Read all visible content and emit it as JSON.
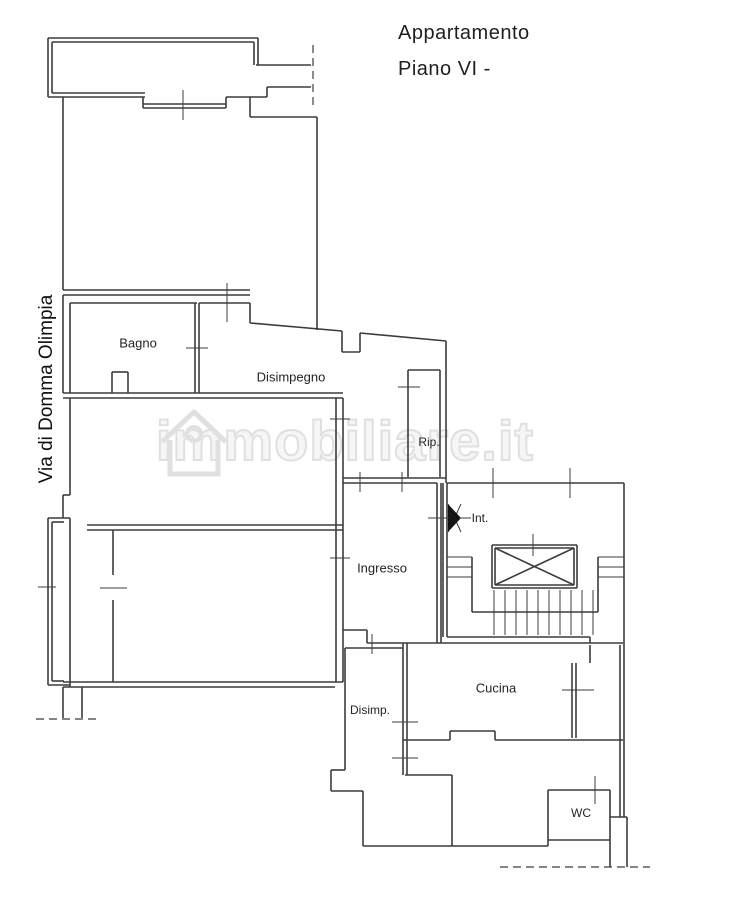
{
  "title": {
    "line1": "Appartamento",
    "line2": "Piano VI -"
  },
  "street_label": "Via di Domma Olimpia",
  "watermark": {
    "text": "immobiliare.it",
    "icon": "house-icon",
    "color": "#e0e0e0"
  },
  "colors": {
    "wall": "#3c3c3c",
    "background": "#ffffff",
    "label": "#242424"
  },
  "rooms": [
    {
      "id": "bagno",
      "label": "Bagno",
      "x": 138,
      "y": 343,
      "size": "normal"
    },
    {
      "id": "disimpegno",
      "label": "Disimpegno",
      "x": 291,
      "y": 377,
      "size": "normal"
    },
    {
      "id": "rip",
      "label": "Rip.",
      "x": 429,
      "y": 442,
      "size": "small"
    },
    {
      "id": "int",
      "label": "Int.",
      "x": 480,
      "y": 518,
      "size": "small"
    },
    {
      "id": "ingresso",
      "label": "Ingresso",
      "x": 382,
      "y": 568,
      "size": "normal"
    },
    {
      "id": "cucina",
      "label": "Cucina",
      "x": 496,
      "y": 688,
      "size": "normal"
    },
    {
      "id": "disimp",
      "label": "Disimp.",
      "x": 370,
      "y": 710,
      "size": "small"
    },
    {
      "id": "wc",
      "label": "WC",
      "x": 581,
      "y": 813,
      "size": "small"
    }
  ],
  "plan": {
    "walls": [
      [
        48,
        38,
        258,
        38
      ],
      [
        48,
        38,
        48,
        97
      ],
      [
        258,
        38,
        258,
        65
      ],
      [
        52,
        42,
        254,
        42
      ],
      [
        52,
        42,
        52,
        93
      ],
      [
        254,
        42,
        254,
        65
      ],
      [
        48,
        97,
        145,
        97
      ],
      [
        52,
        93,
        145,
        93
      ],
      [
        143,
        97,
        143,
        108
      ],
      [
        226,
        97,
        226,
        108
      ],
      [
        143,
        104,
        226,
        104
      ],
      [
        143,
        108,
        226,
        108
      ],
      [
        226,
        97,
        267,
        97
      ],
      [
        267,
        87,
        267,
        97
      ],
      [
        267,
        87,
        311,
        87
      ],
      [
        256,
        65,
        311,
        65
      ],
      [
        63,
        97,
        63,
        290
      ],
      [
        250,
        97,
        250,
        117
      ],
      [
        250,
        117,
        317,
        117
      ],
      [
        317,
        117,
        317,
        330
      ],
      [
        63,
        290,
        250,
        290
      ],
      [
        63,
        295,
        250,
        295
      ],
      [
        63,
        295,
        63,
        393
      ],
      [
        70,
        303,
        197,
        303
      ],
      [
        70,
        303,
        70,
        393
      ],
      [
        63,
        393,
        197,
        393
      ],
      [
        112,
        372,
        112,
        393
      ],
      [
        112,
        372,
        128,
        372
      ],
      [
        128,
        372,
        128,
        393
      ],
      [
        195,
        303,
        195,
        393
      ],
      [
        199,
        303,
        199,
        393
      ],
      [
        199,
        303,
        250,
        303
      ],
      [
        250,
        303,
        250,
        323
      ],
      [
        250,
        323,
        342,
        331
      ],
      [
        342,
        331,
        342,
        352
      ],
      [
        342,
        352,
        360,
        352
      ],
      [
        360,
        352,
        360,
        333
      ],
      [
        360,
        333,
        446,
        341
      ],
      [
        446,
        341,
        446,
        483
      ],
      [
        408,
        370,
        440,
        370
      ],
      [
        408,
        370,
        408,
        477
      ],
      [
        440,
        370,
        440,
        477
      ],
      [
        343,
        478,
        446,
        478
      ],
      [
        343,
        483,
        437,
        483
      ],
      [
        336,
        398,
        336,
        682
      ],
      [
        343,
        398,
        343,
        682
      ],
      [
        63,
        398,
        343,
        398
      ],
      [
        197,
        393,
        343,
        393
      ],
      [
        70,
        398,
        70,
        495
      ],
      [
        70,
        495,
        63,
        495
      ],
      [
        63,
        495,
        63,
        518
      ],
      [
        48,
        518,
        48,
        685
      ],
      [
        48,
        518,
        70,
        518
      ],
      [
        48,
        685,
        70,
        685
      ],
      [
        52,
        522,
        52,
        681
      ],
      [
        52,
        522,
        64,
        522
      ],
      [
        52,
        681,
        64,
        681
      ],
      [
        70,
        518,
        70,
        687
      ],
      [
        87,
        525,
        343,
        525
      ],
      [
        87,
        530,
        343,
        530
      ],
      [
        113,
        530,
        113,
        575
      ],
      [
        113,
        600,
        113,
        682
      ],
      [
        63,
        682,
        343,
        682
      ],
      [
        63,
        687,
        335,
        687
      ],
      [
        63,
        687,
        63,
        718
      ],
      [
        82,
        687,
        82,
        718
      ],
      [
        437,
        483,
        437,
        643
      ],
      [
        441,
        483,
        441,
        643
      ],
      [
        343,
        630,
        367,
        630
      ],
      [
        367,
        630,
        367,
        643
      ],
      [
        443,
        483,
        443,
        637
      ],
      [
        447,
        483,
        447,
        637
      ],
      [
        447,
        483,
        624,
        483
      ],
      [
        624,
        483,
        624,
        645
      ],
      [
        447,
        637,
        590,
        637
      ],
      [
        590,
        637,
        590,
        643
      ],
      [
        492,
        545,
        577,
        545
      ],
      [
        492,
        588,
        577,
        588
      ],
      [
        492,
        545,
        492,
        588
      ],
      [
        577,
        545,
        577,
        588
      ],
      [
        495,
        548,
        574,
        548
      ],
      [
        495,
        585,
        574,
        585
      ],
      [
        495,
        548,
        495,
        585
      ],
      [
        574,
        548,
        574,
        585
      ],
      [
        495,
        548,
        574,
        585
      ],
      [
        495,
        585,
        574,
        548
      ],
      [
        472,
        557,
        472,
        612
      ],
      [
        598,
        557,
        598,
        612
      ],
      [
        472,
        612,
        598,
        612
      ],
      [
        367,
        643,
        623,
        643
      ],
      [
        403,
        643,
        403,
        775
      ],
      [
        407,
        643,
        407,
        775
      ],
      [
        403,
        740,
        450,
        740
      ],
      [
        450,
        740,
        450,
        731
      ],
      [
        450,
        731,
        495,
        731
      ],
      [
        495,
        731,
        495,
        740
      ],
      [
        495,
        740,
        623,
        740
      ],
      [
        572,
        663,
        572,
        738
      ],
      [
        576,
        663,
        576,
        738
      ],
      [
        590,
        645,
        590,
        663
      ],
      [
        620,
        645,
        620,
        817
      ],
      [
        624,
        645,
        624,
        817
      ],
      [
        345,
        648,
        345,
        770
      ],
      [
        345,
        648,
        403,
        648
      ],
      [
        345,
        770,
        331,
        770
      ],
      [
        331,
        770,
        331,
        791
      ],
      [
        331,
        791,
        363,
        791
      ],
      [
        363,
        791,
        363,
        846
      ],
      [
        363,
        846,
        548,
        846
      ],
      [
        405,
        775,
        452,
        775
      ],
      [
        452,
        775,
        452,
        846
      ],
      [
        548,
        790,
        548,
        846
      ],
      [
        548,
        790,
        610,
        790
      ],
      [
        548,
        840,
        610,
        840
      ],
      [
        610,
        790,
        610,
        867
      ],
      [
        610,
        817,
        627,
        817
      ],
      [
        627,
        817,
        627,
        867
      ]
    ],
    "ticks": [
      [
        183,
        90,
        183,
        120
      ],
      [
        227,
        283,
        227,
        322
      ],
      [
        186,
        348,
        208,
        348
      ],
      [
        398,
        387,
        420,
        387
      ],
      [
        330,
        419,
        350,
        419
      ],
      [
        330,
        558,
        350,
        558
      ],
      [
        38,
        587,
        56,
        587
      ],
      [
        100,
        588,
        127,
        588
      ],
      [
        360,
        472,
        360,
        492
      ],
      [
        402,
        472,
        402,
        492
      ],
      [
        428,
        518,
        450,
        518
      ],
      [
        493,
        468,
        493,
        498
      ],
      [
        570,
        468,
        570,
        498
      ],
      [
        533,
        534,
        533,
        556
      ],
      [
        372,
        634,
        372,
        654
      ],
      [
        392,
        722,
        418,
        722
      ],
      [
        392,
        758,
        418,
        758
      ],
      [
        562,
        690,
        594,
        690
      ],
      [
        595,
        776,
        595,
        804
      ],
      [
        447,
        557,
        472,
        557
      ],
      [
        447,
        567,
        472,
        567
      ],
      [
        447,
        577,
        472,
        577
      ],
      [
        598,
        557,
        624,
        557
      ],
      [
        598,
        567,
        624,
        567
      ],
      [
        598,
        577,
        624,
        577
      ],
      [
        494,
        590,
        494,
        635
      ],
      [
        505,
        590,
        505,
        635
      ],
      [
        516,
        590,
        516,
        635
      ],
      [
        527,
        590,
        527,
        635
      ],
      [
        538,
        590,
        538,
        635
      ],
      [
        549,
        590,
        549,
        635
      ],
      [
        560,
        590,
        560,
        635
      ],
      [
        571,
        590,
        571,
        635
      ],
      [
        582,
        590,
        582,
        635
      ],
      [
        593,
        590,
        593,
        635
      ],
      [
        461,
        518,
        471,
        518
      ],
      [
        448,
        504,
        461,
        532
      ],
      [
        448,
        532,
        461,
        504
      ]
    ],
    "dashed": [
      [
        313,
        45,
        313,
        108
      ],
      [
        36,
        719,
        100,
        719
      ],
      [
        500,
        867,
        650,
        867
      ]
    ],
    "door_triangle": "448,504 448,532 461,518"
  }
}
